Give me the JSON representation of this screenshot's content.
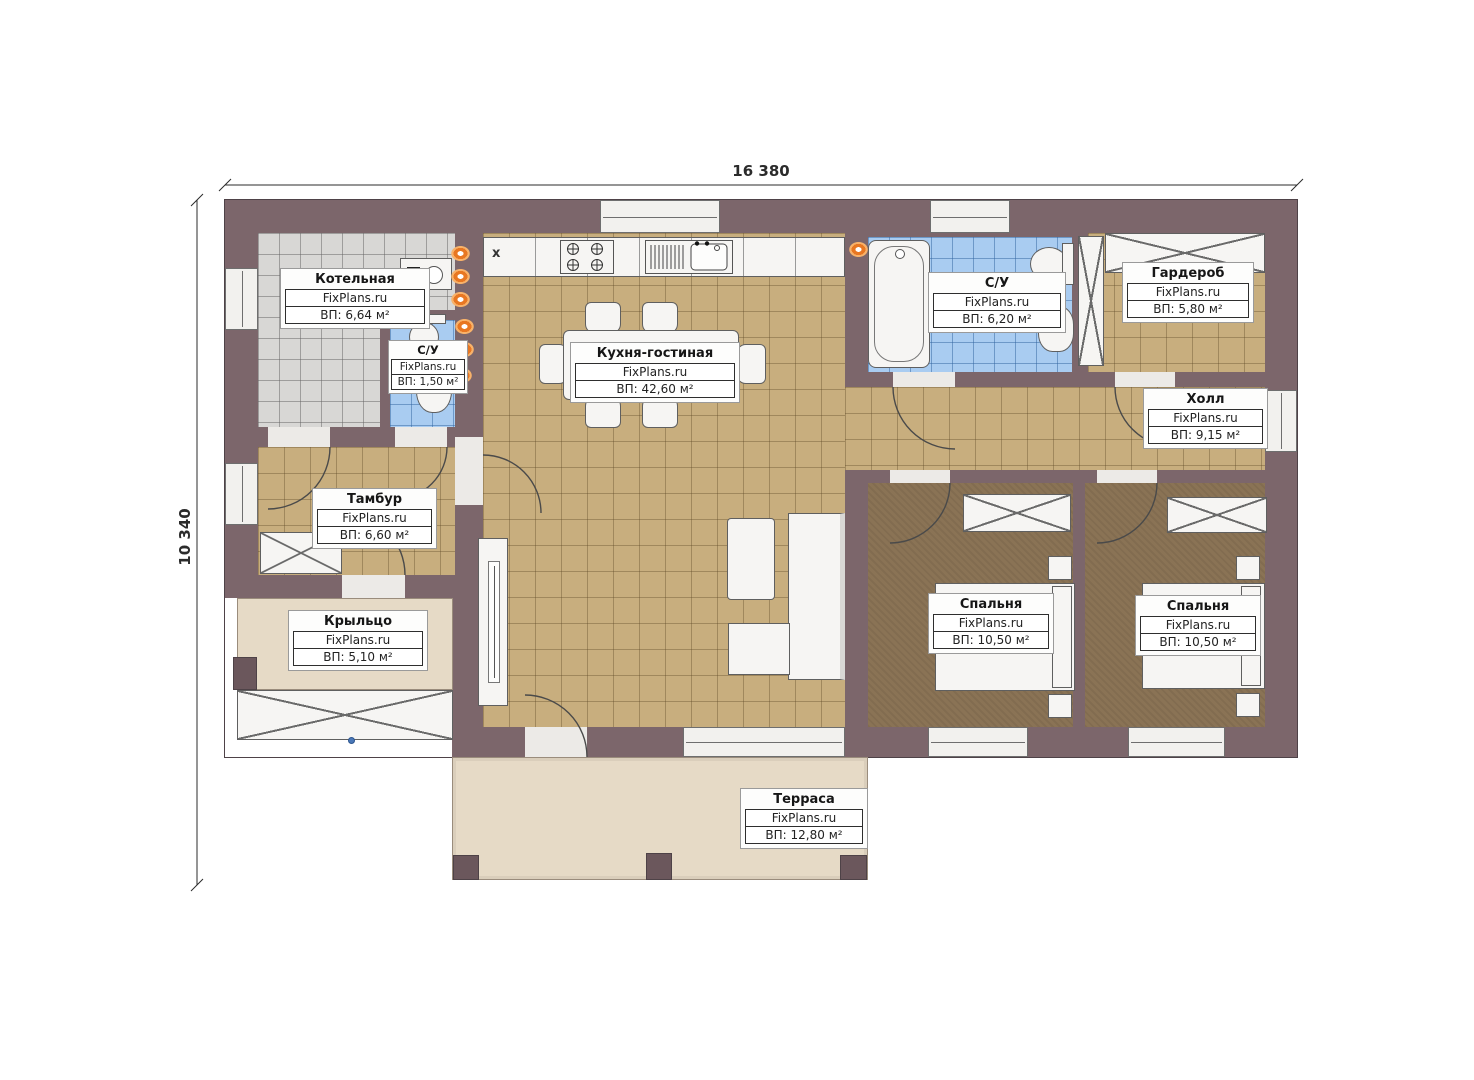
{
  "plan": {
    "dimensions": {
      "top": "16 380",
      "left": "10 340"
    },
    "watermark": "FixPlans.ru",
    "vent_marker": "x",
    "rooms": {
      "boiler": {
        "name": "Котельная",
        "area": "ВП: 6,64 м²"
      },
      "wc_small": {
        "name": "С/У",
        "area": "ВП: 1,50 м²"
      },
      "kitchen": {
        "name": "Кухня-гостиная",
        "area": "ВП: 42,60 м²"
      },
      "wc_main": {
        "name": "С/У",
        "area": "ВП: 6,20 м²"
      },
      "wardrobe": {
        "name": "Гардероб",
        "area": "ВП: 5,80 м²"
      },
      "hall": {
        "name": "Холл",
        "area": "ВП: 9,15 м²"
      },
      "tambur": {
        "name": "Тамбур",
        "area": "ВП: 6,60 м²"
      },
      "porch": {
        "name": "Крыльцо",
        "area": "ВП: 5,10 м²"
      },
      "bedroom1": {
        "name": "Спальня",
        "area": "ВП: 10,50 м²"
      },
      "bedroom2": {
        "name": "Спальня",
        "area": "ВП: 10,50 м²"
      },
      "terrace": {
        "name": "Терраса",
        "area": "ВП: 12,80 м²"
      }
    },
    "colors": {
      "wall": "#7c666b",
      "floor_tile_tan": "#c8ae7e",
      "floor_tile_gray": "#d8d7d5",
      "floor_tile_blue": "#a9ccf1",
      "floor_bedroom": "#8a7355",
      "floor_terrace": "#e6dac6",
      "fixture": "#f6f5f3",
      "heating_marker": "#e87722"
    }
  }
}
